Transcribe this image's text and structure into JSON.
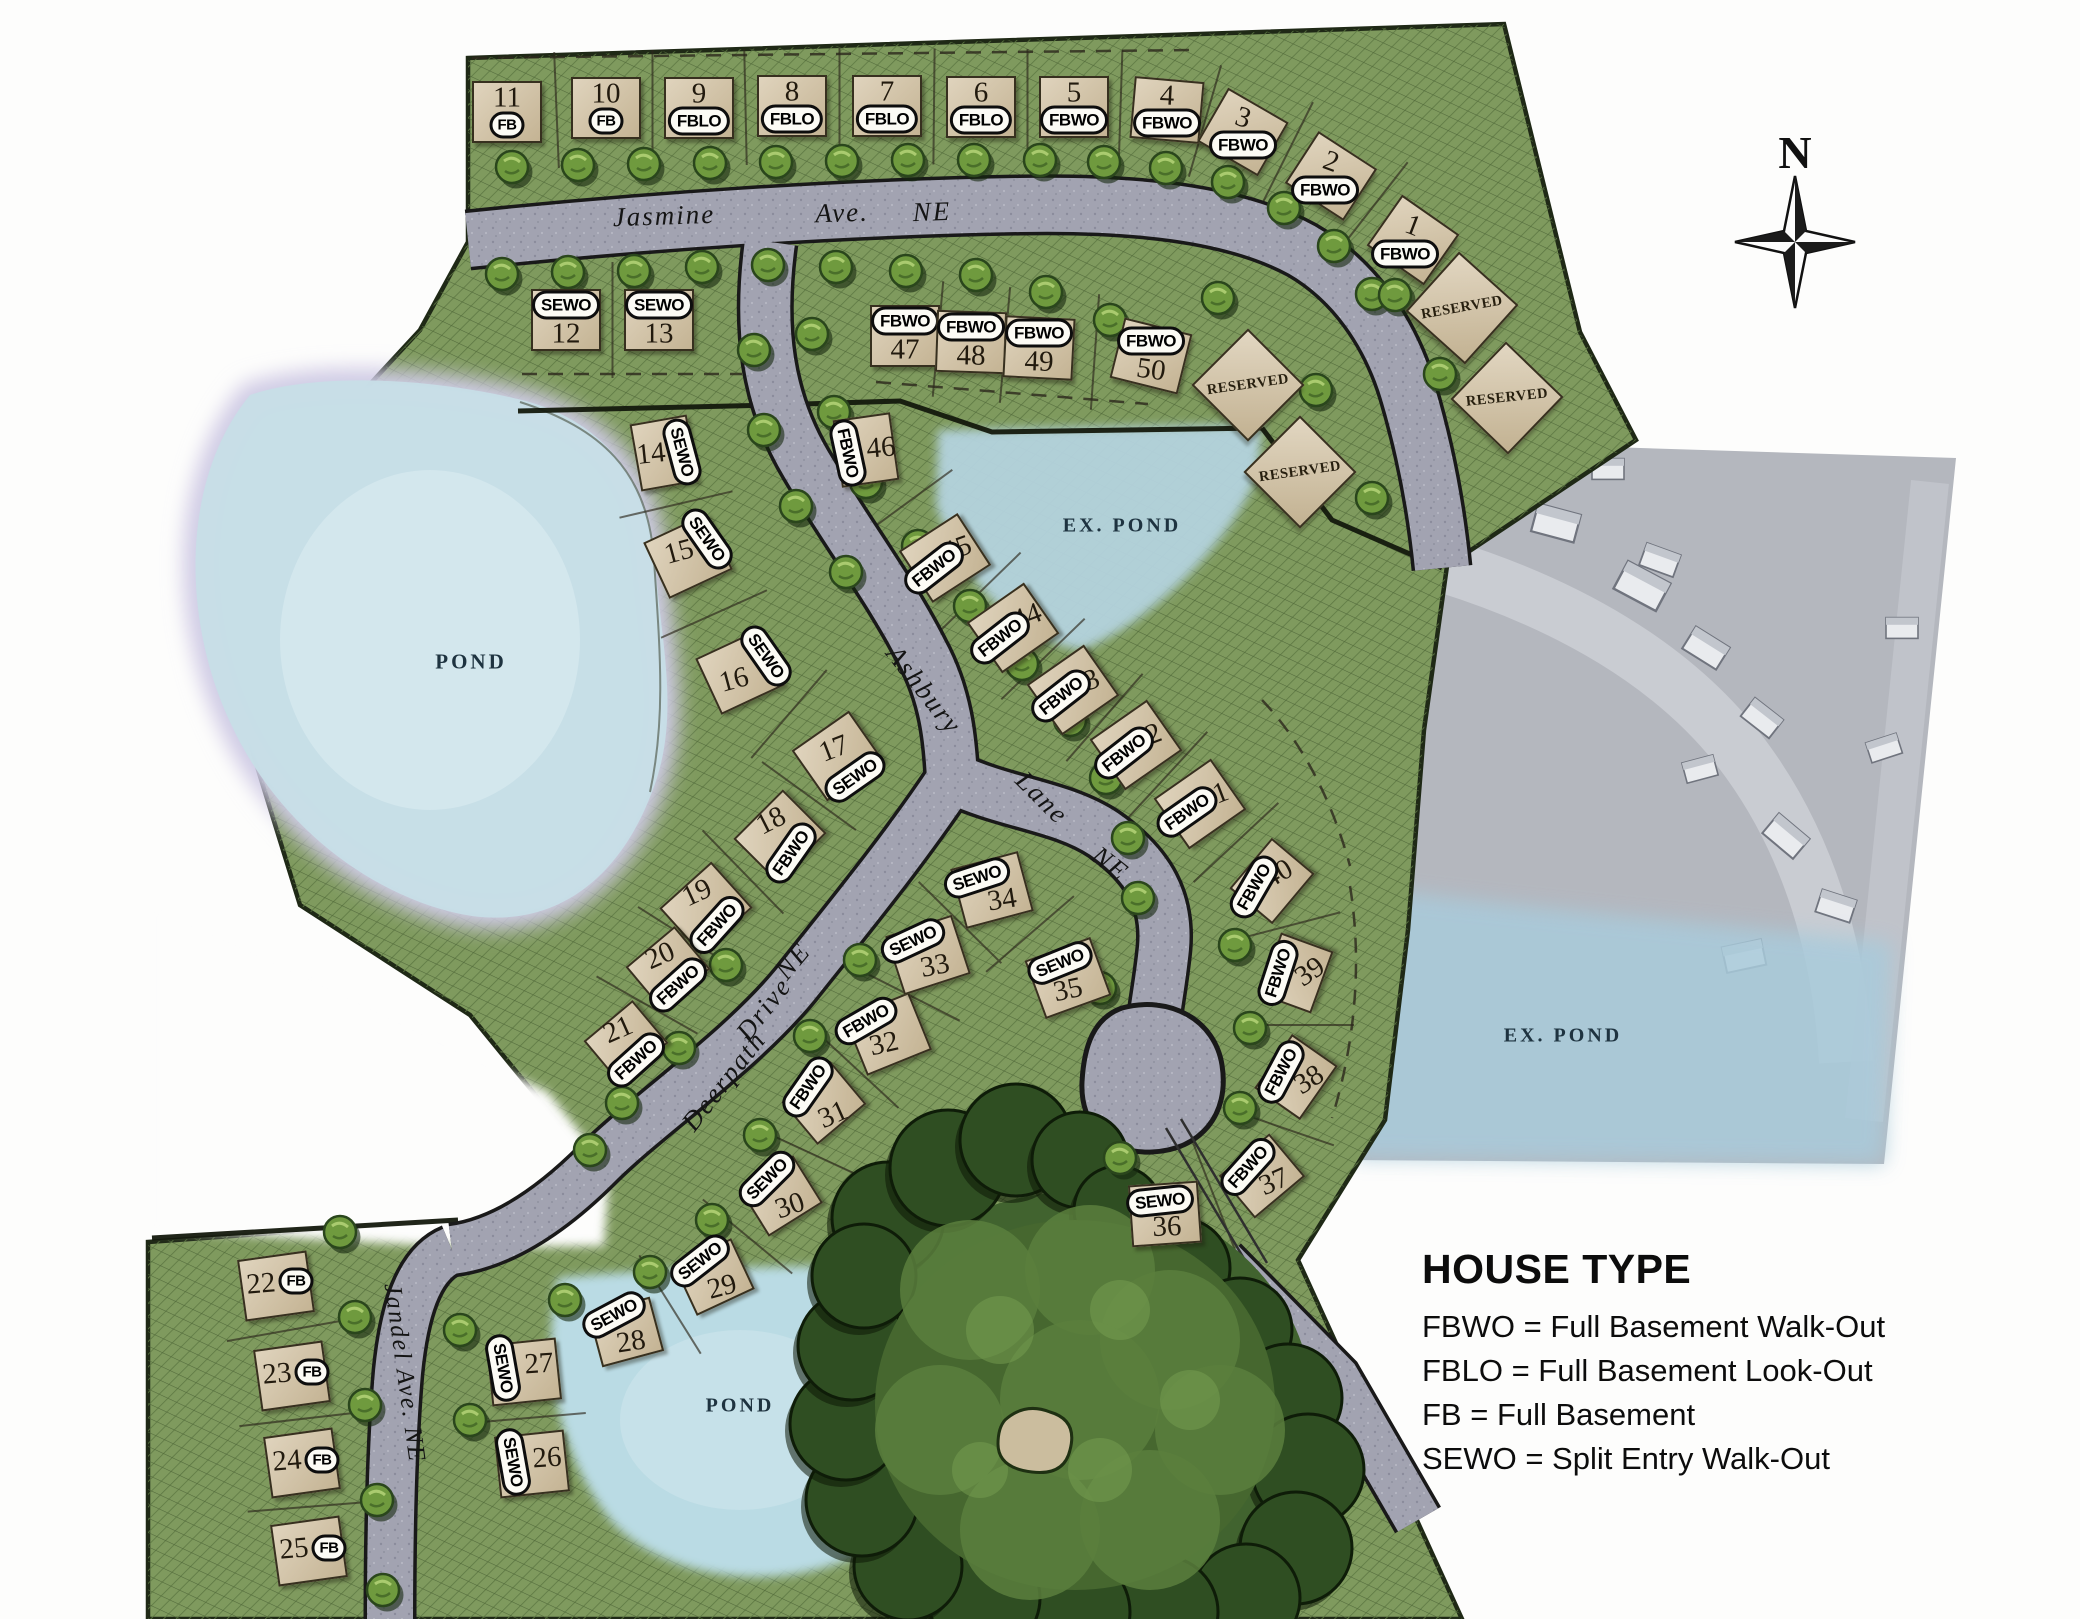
{
  "compass": {
    "label": "N"
  },
  "legend": {
    "title": "HOUSE TYPE",
    "entries": [
      {
        "abbr": "FBWO",
        "meaning": "Full Basement Walk-Out",
        "text": "FBWO = Full Basement Walk-Out"
      },
      {
        "abbr": "FBLO",
        "meaning": "Full Basement Look-Out",
        "text": "FBLO = Full Basement Look-Out"
      },
      {
        "abbr": "FB",
        "meaning": "Full Basement",
        "text": "FB = Full Basement"
      },
      {
        "abbr": "SEWO",
        "meaning": "Split Entry Walk-Out",
        "text": "SEWO = Split Entry Walk-Out"
      }
    ]
  },
  "streets": [
    {
      "name": "Jasmine",
      "x": 664,
      "y": 216,
      "rot": -2
    },
    {
      "name": "Ave.",
      "x": 842,
      "y": 213,
      "rot": -2
    },
    {
      "name": "NE",
      "x": 932,
      "y": 212,
      "rot": -2
    },
    {
      "name": "Ashbury",
      "x": 924,
      "y": 690,
      "rot": 52
    },
    {
      "name": "Lane",
      "x": 1042,
      "y": 798,
      "rot": 45
    },
    {
      "name": "NE",
      "x": 1110,
      "y": 864,
      "rot": 38
    },
    {
      "name": "Deerpath",
      "x": 724,
      "y": 1081,
      "rot": -52
    },
    {
      "name": "Drive",
      "x": 764,
      "y": 1009,
      "rot": -52
    },
    {
      "name": "NE",
      "x": 793,
      "y": 961,
      "rot": -50
    },
    {
      "name": "Jandel Ave. NE",
      "x": 404,
      "y": 1373,
      "rot": 82,
      "size": 25
    }
  ],
  "ponds": [
    {
      "label": "POND",
      "x": 471,
      "y": 662
    },
    {
      "label": "EX. POND",
      "x": 1122,
      "y": 526,
      "size": 20
    },
    {
      "label": "EX. POND",
      "x": 1563,
      "y": 1036,
      "size": 20
    },
    {
      "label": "POND",
      "x": 740,
      "y": 1406,
      "size": 20
    }
  ],
  "lots": [
    {
      "n": "11",
      "t": "FB",
      "x": 507,
      "y": 112
    },
    {
      "n": "10",
      "t": "FB",
      "x": 606,
      "y": 108
    },
    {
      "n": "9",
      "t": "FBLO",
      "x": 699,
      "y": 108
    },
    {
      "n": "8",
      "t": "FBLO",
      "x": 792,
      "y": 106
    },
    {
      "n": "7",
      "t": "FBLO",
      "x": 887,
      "y": 106
    },
    {
      "n": "6",
      "t": "FBLO",
      "x": 981,
      "y": 107
    },
    {
      "n": "5",
      "t": "FBWO",
      "x": 1074,
      "y": 107
    },
    {
      "n": "4",
      "t": "FBWO",
      "x": 1167,
      "y": 110,
      "r": 5
    },
    {
      "n": "3",
      "t": "FBWO",
      "x": 1243,
      "y": 132,
      "r": 30
    },
    {
      "n": "2",
      "t": "FBWO",
      "x": 1331,
      "y": 176,
      "r": 33,
      "pd": [
        -6,
        14
      ]
    },
    {
      "n": "1",
      "t": "FBWO",
      "x": 1413,
      "y": 240,
      "r": 35,
      "pd": [
        -8,
        14
      ]
    },
    {
      "n": "12",
      "t": "SEWO",
      "x": 566,
      "y": 320,
      "nd": [
        0,
        14
      ],
      "pd": [
        0,
        -15
      ]
    },
    {
      "n": "13",
      "t": "SEWO",
      "x": 659,
      "y": 320,
      "nd": [
        0,
        14
      ],
      "pd": [
        0,
        -15
      ]
    },
    {
      "n": "47",
      "t": "FBWO",
      "x": 905,
      "y": 336,
      "nd": [
        0,
        14
      ],
      "pd": [
        0,
        -15
      ]
    },
    {
      "n": "48",
      "t": "FBWO",
      "x": 971,
      "y": 342,
      "r": 2,
      "nd": [
        0,
        14
      ],
      "pd": [
        0,
        -15
      ]
    },
    {
      "n": "49",
      "t": "FBWO",
      "x": 1039,
      "y": 348,
      "r": 3,
      "nd": [
        0,
        14
      ],
      "pd": [
        0,
        -15
      ]
    },
    {
      "n": "50",
      "t": "FBWO",
      "x": 1151,
      "y": 356,
      "r": 14,
      "nd": [
        0,
        14
      ],
      "pd": [
        0,
        -15
      ]
    },
    {
      "n": "14",
      "t": "SEWO",
      "x": 664,
      "y": 453,
      "r": -10,
      "w": 54,
      "h": 64,
      "nd": [
        -13,
        1
      ],
      "pd": [
        18,
        -1
      ],
      "pr": 75
    },
    {
      "n": "15",
      "t": "SEWO",
      "x": 688,
      "y": 556,
      "r": -25,
      "nd": [
        -9,
        -4
      ],
      "pd": [
        19,
        -17
      ],
      "pr": 55
    },
    {
      "n": "16",
      "t": "SEWO",
      "x": 740,
      "y": 672,
      "r": -25,
      "nd": [
        -6,
        8
      ],
      "pd": [
        26,
        -16
      ],
      "pr": 55
    },
    {
      "n": "17",
      "t": "SEWO",
      "x": 838,
      "y": 756,
      "r": -35,
      "nd": [
        -4,
        -7
      ],
      "pd": [
        17,
        21
      ],
      "pr": -35
    },
    {
      "n": "18",
      "t": "FBWO",
      "x": 780,
      "y": 836,
      "r": -45,
      "nd": [
        -9,
        -15
      ],
      "pd": [
        11,
        17
      ],
      "pr": -55
    },
    {
      "n": "19",
      "t": "FBWO",
      "x": 706,
      "y": 908,
      "r": -42,
      "nd": [
        -9,
        -15
      ],
      "pd": [
        11,
        17
      ],
      "pr": -48
    },
    {
      "n": "20",
      "t": "FBWO",
      "x": 668,
      "y": 968,
      "r": -40,
      "w": 60,
      "h": 52,
      "nd": [
        -8,
        -12
      ],
      "pd": [
        10,
        17
      ],
      "pr": -42
    },
    {
      "n": "21",
      "t": "FBWO",
      "x": 626,
      "y": 1042,
      "r": -40,
      "w": 60,
      "h": 52,
      "nd": [
        -8,
        -12
      ],
      "pd": [
        10,
        18
      ],
      "pr": -42
    },
    {
      "n": "22",
      "t": "FB",
      "x": 276,
      "y": 1286,
      "r": -8,
      "nd": [
        -15,
        -2
      ],
      "pd": [
        20,
        -5
      ]
    },
    {
      "n": "23",
      "t": "FB",
      "x": 292,
      "y": 1376,
      "r": -8,
      "nd": [
        -15,
        -2
      ],
      "pd": [
        20,
        -4
      ]
    },
    {
      "n": "24",
      "t": "FB",
      "x": 302,
      "y": 1463,
      "r": -8,
      "nd": [
        -15,
        -2
      ],
      "pd": [
        20,
        -3
      ]
    },
    {
      "n": "25",
      "t": "FB",
      "x": 309,
      "y": 1551,
      "r": -8,
      "nd": [
        -15,
        -2
      ],
      "pd": [
        20,
        -3
      ]
    },
    {
      "n": "26",
      "t": "SEWO",
      "x": 532,
      "y": 1464,
      "r": -6,
      "nd": [
        15,
        -6
      ],
      "pd": [
        -19,
        -2
      ],
      "pr": 80
    },
    {
      "n": "27",
      "t": "SEWO",
      "x": 524,
      "y": 1372,
      "r": -6,
      "nd": [
        15,
        -8
      ],
      "pd": [
        -21,
        -4
      ],
      "pr": 80
    },
    {
      "n": "28",
      "t": "SEWO",
      "x": 626,
      "y": 1332,
      "r": -15,
      "w": 60,
      "h": 52,
      "nd": [
        5,
        10
      ],
      "pd": [
        -12,
        -17
      ],
      "pr": -28
    },
    {
      "n": "29",
      "t": "SEWO",
      "x": 714,
      "y": 1277,
      "r": -25,
      "w": 60,
      "h": 52,
      "nd": [
        8,
        10
      ],
      "pd": [
        -14,
        -16
      ],
      "pr": -38
    },
    {
      "n": "30",
      "t": "SEWO",
      "x": 781,
      "y": 1196,
      "r": -32,
      "w": 60,
      "h": 52,
      "nd": [
        9,
        10
      ],
      "pd": [
        -14,
        -17
      ],
      "pr": -45
    },
    {
      "n": "31",
      "t": "FBWO",
      "x": 824,
      "y": 1103,
      "r": -40,
      "w": 60,
      "h": 52,
      "nd": [
        9,
        12
      ],
      "pd": [
        -16,
        -16
      ],
      "pr": -55
    },
    {
      "n": "32",
      "t": "FBWO",
      "x": 888,
      "y": 1034,
      "r": -22,
      "nd": [
        -4,
        10
      ],
      "pd": [
        -22,
        -13
      ],
      "pr": -30
    },
    {
      "n": "33",
      "t": "SEWO",
      "x": 928,
      "y": 955,
      "r": -18,
      "nd": [
        7,
        11
      ],
      "pd": [
        -15,
        -14
      ],
      "pr": -25
    },
    {
      "n": "34",
      "t": "SEWO",
      "x": 992,
      "y": 890,
      "r": -15,
      "nd": [
        10,
        10
      ],
      "pd": [
        -15,
        -12
      ],
      "pr": -18
    },
    {
      "n": "35",
      "t": "SEWO",
      "x": 1068,
      "y": 978,
      "r": -20,
      "nd": [
        0,
        12
      ],
      "pd": [
        -8,
        -15
      ],
      "pr": -22
    },
    {
      "n": "36",
      "t": "SEWO",
      "x": 1165,
      "y": 1214,
      "r": -4,
      "nd": [
        2,
        13
      ],
      "pd": [
        -5,
        -13
      ],
      "pr": -6
    },
    {
      "n": "37",
      "t": "FBWO",
      "x": 1262,
      "y": 1176,
      "r": -40,
      "w": 62,
      "h": 52,
      "nd": [
        12,
        6
      ],
      "pd": [
        -14,
        -9
      ],
      "pr": -48
    },
    {
      "n": "38",
      "t": "FBWO",
      "x": 1296,
      "y": 1077,
      "r": -55,
      "w": 62,
      "h": 52,
      "nd": [
        13,
        3
      ],
      "pd": [
        -15,
        -5
      ],
      "pr": -62
    },
    {
      "n": "39",
      "t": "FBWO",
      "x": 1296,
      "y": 973,
      "r": -70,
      "w": 62,
      "h": 52,
      "nd": [
        14,
        -1
      ],
      "pd": [
        -18,
        0
      ],
      "pr": -72
    },
    {
      "n": "40",
      "t": "FBWO",
      "x": 1272,
      "y": 881,
      "r": -50,
      "w": 62,
      "h": 52,
      "nd": [
        6,
        -7
      ],
      "pd": [
        -18,
        6
      ],
      "pr": -60
    },
    {
      "n": "41",
      "t": "FBWO",
      "x": 1200,
      "y": 804,
      "r": -35,
      "nd": [
        14,
        -8
      ],
      "pd": [
        -13,
        8
      ],
      "pr": -35
    },
    {
      "n": "42",
      "t": "FBWO",
      "x": 1136,
      "y": 745,
      "r": -35,
      "nd": [
        11,
        -8
      ],
      "pd": [
        -12,
        8
      ],
      "pr": -38
    },
    {
      "n": "43",
      "t": "FBWO",
      "x": 1073,
      "y": 690,
      "r": -35,
      "nd": [
        12,
        -7
      ],
      "pd": [
        -12,
        6
      ],
      "pr": -38
    },
    {
      "n": "44",
      "t": "FBWO",
      "x": 1013,
      "y": 628,
      "r": -35,
      "nd": [
        14,
        -11
      ],
      "pd": [
        -13,
        10
      ],
      "pr": -38
    },
    {
      "n": "45",
      "t": "FBWO",
      "x": 945,
      "y": 558,
      "r": -33,
      "nd": [
        12,
        -9
      ],
      "pd": [
        -11,
        10
      ],
      "pr": -38
    },
    {
      "n": "46",
      "t": "FBWO",
      "x": 866,
      "y": 450,
      "r": -8,
      "w": 54,
      "h": 64,
      "nd": [
        15,
        -2
      ],
      "pd": [
        -18,
        3
      ],
      "pr": 78
    }
  ],
  "reserved": [
    {
      "label": "RESERVED",
      "x": 1248,
      "y": 385,
      "r": 45,
      "tr": -8
    },
    {
      "label": "RESERVED",
      "x": 1462,
      "y": 308,
      "r": 42,
      "tr": -10
    },
    {
      "label": "RESERVED",
      "x": 1507,
      "y": 398,
      "r": 44,
      "tr": -6
    },
    {
      "label": "RESERVED",
      "x": 1300,
      "y": 472,
      "r": 45,
      "tr": -8
    }
  ],
  "colors": {
    "green": "#7f9a5e",
    "road": "#a2a3b1",
    "pond": "#c7dee7",
    "pad": "#d5c5a7",
    "outline": "#1f2916"
  }
}
